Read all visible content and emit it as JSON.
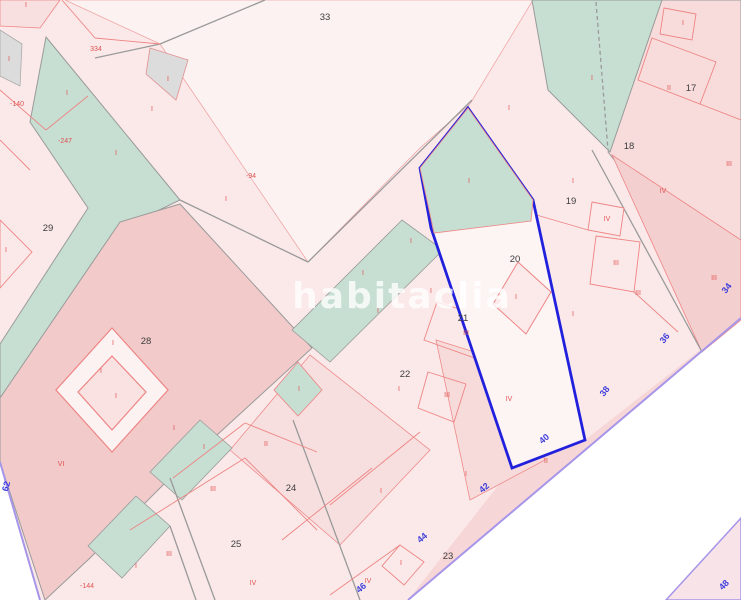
{
  "map": {
    "watermark": "habitaclia",
    "colors": {
      "background": "#ffffff",
      "parcel_pale": "#fbe9e9",
      "parcel_light": "#fdf2f2",
      "parcel_mid": "#f8dcdc",
      "parcel_dark": "#f2caca",
      "green_parcel": "#c6dfd2",
      "gray_parcel": "#dcdcdc",
      "boundary_red": "#ee8484",
      "boundary_gray": "#9a9a9a",
      "selected_outline": "#2121dd",
      "road_edge": "#a795e9",
      "label_black": "#3d3d3d",
      "label_red": "#e05252",
      "label_blue": "#3d3ddb"
    },
    "parcel_numbers": [
      {
        "text": "33",
        "x": 325,
        "y": 20
      },
      {
        "text": "29",
        "x": 48,
        "y": 231
      },
      {
        "text": "28",
        "x": 146,
        "y": 344
      },
      {
        "text": "17",
        "x": 691,
        "y": 91
      },
      {
        "text": "18",
        "x": 629,
        "y": 149
      },
      {
        "text": "19",
        "x": 571,
        "y": 204
      },
      {
        "text": "20",
        "x": 515,
        "y": 262
      },
      {
        "text": "21",
        "x": 463,
        "y": 321
      },
      {
        "text": "22",
        "x": 405,
        "y": 377
      },
      {
        "text": "23",
        "x": 448,
        "y": 559
      },
      {
        "text": "24",
        "x": 291,
        "y": 491
      },
      {
        "text": "25",
        "x": 236,
        "y": 547
      }
    ],
    "subparcel_labels": [
      {
        "text": "334",
        "x": 96,
        "y": 51
      },
      {
        "text": "-94",
        "x": 251,
        "y": 178
      },
      {
        "text": "-140",
        "x": 17,
        "y": 106
      },
      {
        "text": "-247",
        "x": 65,
        "y": 143
      },
      {
        "text": "-144",
        "x": 87,
        "y": 588
      },
      {
        "text": "I",
        "x": 67,
        "y": 95
      },
      {
        "text": "I",
        "x": 116,
        "y": 155
      },
      {
        "text": "I",
        "x": 152,
        "y": 111
      },
      {
        "text": "I",
        "x": 226,
        "y": 201
      },
      {
        "text": "I",
        "x": 9,
        "y": 61
      },
      {
        "text": "I",
        "x": 168,
        "y": 81
      },
      {
        "text": "I",
        "x": 6,
        "y": 252
      },
      {
        "text": "I",
        "x": 101,
        "y": 373
      },
      {
        "text": "I",
        "x": 363,
        "y": 275
      },
      {
        "text": "I",
        "x": 431,
        "y": 293
      },
      {
        "text": "I",
        "x": 378,
        "y": 313
      },
      {
        "text": "I",
        "x": 411,
        "y": 243
      },
      {
        "text": "I",
        "x": 469,
        "y": 183
      },
      {
        "text": "I",
        "x": 516,
        "y": 299
      },
      {
        "text": "I",
        "x": 573,
        "y": 183
      },
      {
        "text": "I",
        "x": 573,
        "y": 316
      },
      {
        "text": "I",
        "x": 592,
        "y": 80
      },
      {
        "text": "I",
        "x": 683,
        "y": 25
      },
      {
        "text": "I",
        "x": 509,
        "y": 110
      },
      {
        "text": "I",
        "x": 113,
        "y": 345
      },
      {
        "text": "I",
        "x": 116,
        "y": 398
      },
      {
        "text": "I",
        "x": 399,
        "y": 391
      },
      {
        "text": "I",
        "x": 381,
        "y": 493
      },
      {
        "text": "I",
        "x": 466,
        "y": 476
      },
      {
        "text": "I",
        "x": 174,
        "y": 430
      },
      {
        "text": "I",
        "x": 299,
        "y": 391
      },
      {
        "text": "I",
        "x": 204,
        "y": 449
      },
      {
        "text": "I",
        "x": 136,
        "y": 568
      },
      {
        "text": "I",
        "x": 401,
        "y": 565
      },
      {
        "text": "I",
        "x": 26,
        "y": 7
      },
      {
        "text": "II",
        "x": 669,
        "y": 90
      },
      {
        "text": "II",
        "x": 266,
        "y": 446
      },
      {
        "text": "II",
        "x": 546,
        "y": 463
      },
      {
        "text": "III",
        "x": 729,
        "y": 166
      },
      {
        "text": "III",
        "x": 616,
        "y": 265
      },
      {
        "text": "III",
        "x": 714,
        "y": 280
      },
      {
        "text": "III",
        "x": 466,
        "y": 335
      },
      {
        "text": "III",
        "x": 447,
        "y": 397
      },
      {
        "text": "III",
        "x": 213,
        "y": 491
      },
      {
        "text": "III",
        "x": 169,
        "y": 556
      },
      {
        "text": "III",
        "x": 638,
        "y": 295
      },
      {
        "text": "IV",
        "x": 663,
        "y": 193
      },
      {
        "text": "IV",
        "x": 607,
        "y": 221
      },
      {
        "text": "IV",
        "x": 509,
        "y": 401
      },
      {
        "text": "IV",
        "x": 253,
        "y": 585
      },
      {
        "text": "IV",
        "x": 368,
        "y": 583
      },
      {
        "text": "VI",
        "x": 61,
        "y": 466
      }
    ],
    "street_numbers": [
      {
        "text": "34",
        "x": 729,
        "y": 290,
        "rot": -52
      },
      {
        "text": "36",
        "x": 667,
        "y": 340,
        "rot": -52
      },
      {
        "text": "38",
        "x": 607,
        "y": 393,
        "rot": -52
      },
      {
        "text": "40",
        "x": 546,
        "y": 441,
        "rot": -40
      },
      {
        "text": "42",
        "x": 486,
        "y": 490,
        "rot": -40
      },
      {
        "text": "44",
        "x": 424,
        "y": 540,
        "rot": -40
      },
      {
        "text": "46",
        "x": 363,
        "y": 590,
        "rot": -40
      },
      {
        "text": "48",
        "x": 726,
        "y": 587,
        "rot": -45
      },
      {
        "text": "62",
        "x": 9,
        "y": 487,
        "rot": -75
      }
    ]
  }
}
